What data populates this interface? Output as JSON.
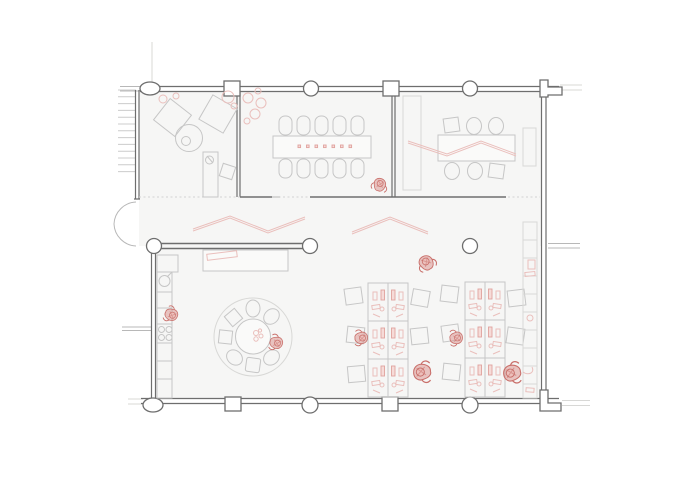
{
  "colors": {
    "background": "#ffffff",
    "floor": "#f6f6f5",
    "floor_light": "#fafaf9",
    "wall": "#6e6e6e",
    "wall_faint": "#b8b8b8",
    "furniture": "#c6c6c6",
    "furniture_light": "#d8d8d6",
    "hatch": "#cccccc",
    "dash": "#d2d2d2",
    "pink": "#eabfbc",
    "pink_strong": "#e0a29e",
    "person_fill": "#d6837e",
    "person_stroke": "#c96f6a"
  },
  "plan": {
    "type": "architectural-floor-plan",
    "features": [
      "stairs",
      "entrance-double-door",
      "lounge",
      "meeting-room-left",
      "meeting-room-right",
      "corridor",
      "reception-desk",
      "kitchenette",
      "round-table-group",
      "desk-bank-1",
      "desk-bank-2",
      "storage-cabinets",
      "structural-columns",
      "people-figures"
    ]
  }
}
